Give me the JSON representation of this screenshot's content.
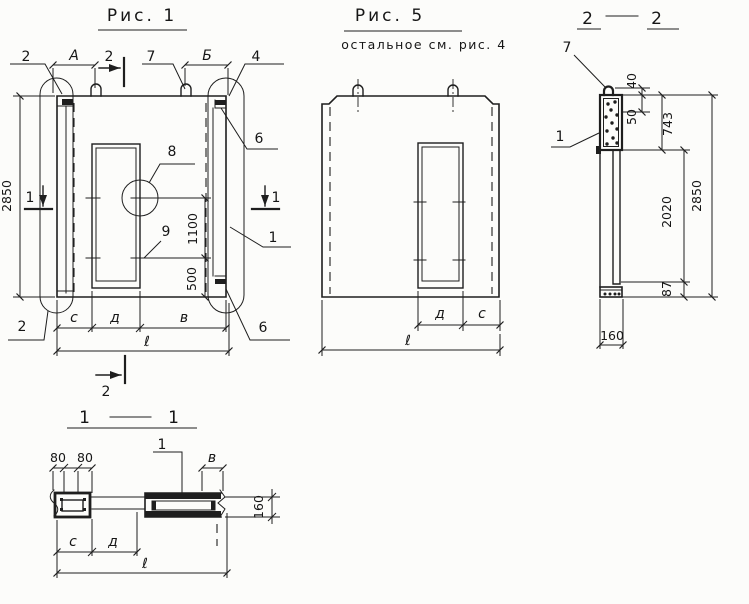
{
  "palette": {
    "paper": "#fcfcfa",
    "ink": "#1e1e1e"
  },
  "fig1": {
    "title": "Рис. 1",
    "marks": {
      "detail_top_left": "2",
      "section_top": "2",
      "loop_callout": "7",
      "corner_callout": "4",
      "groove_top": "6",
      "opening_detail": "8",
      "jamb_detail": "9",
      "panel_callout": "1",
      "groove_bottom": "6",
      "detail_bottom_left": "2",
      "section_bottom": "2",
      "section_left": "1",
      "section_right": "1"
    },
    "dims": {
      "a": "А",
      "b": "Б",
      "h2850": "2850",
      "v1100": "1100",
      "v500": "500",
      "c": "с",
      "d": "д",
      "v": "в",
      "len": "ℓ"
    }
  },
  "fig5": {
    "title": "Рис. 5",
    "subtitle": "остальное  см. рис. 4",
    "dims": {
      "d": "д",
      "c": "с",
      "len": "ℓ"
    }
  },
  "sec22": {
    "title_a": "2",
    "title_b": "2",
    "marks": {
      "loop": "7",
      "block": "1"
    },
    "dims": {
      "v40": "40",
      "v50": "50",
      "v743": "743",
      "v2020": "2020",
      "v87": "87",
      "v2850": "2850",
      "w160": "160"
    }
  },
  "sec11": {
    "title_a": "1",
    "title_b": "1",
    "marks": {
      "block": "1"
    },
    "dims": {
      "w80a": "80",
      "w80b": "80",
      "v": "в",
      "t160": "160",
      "c": "с",
      "d": "д",
      "len": "ℓ"
    }
  }
}
